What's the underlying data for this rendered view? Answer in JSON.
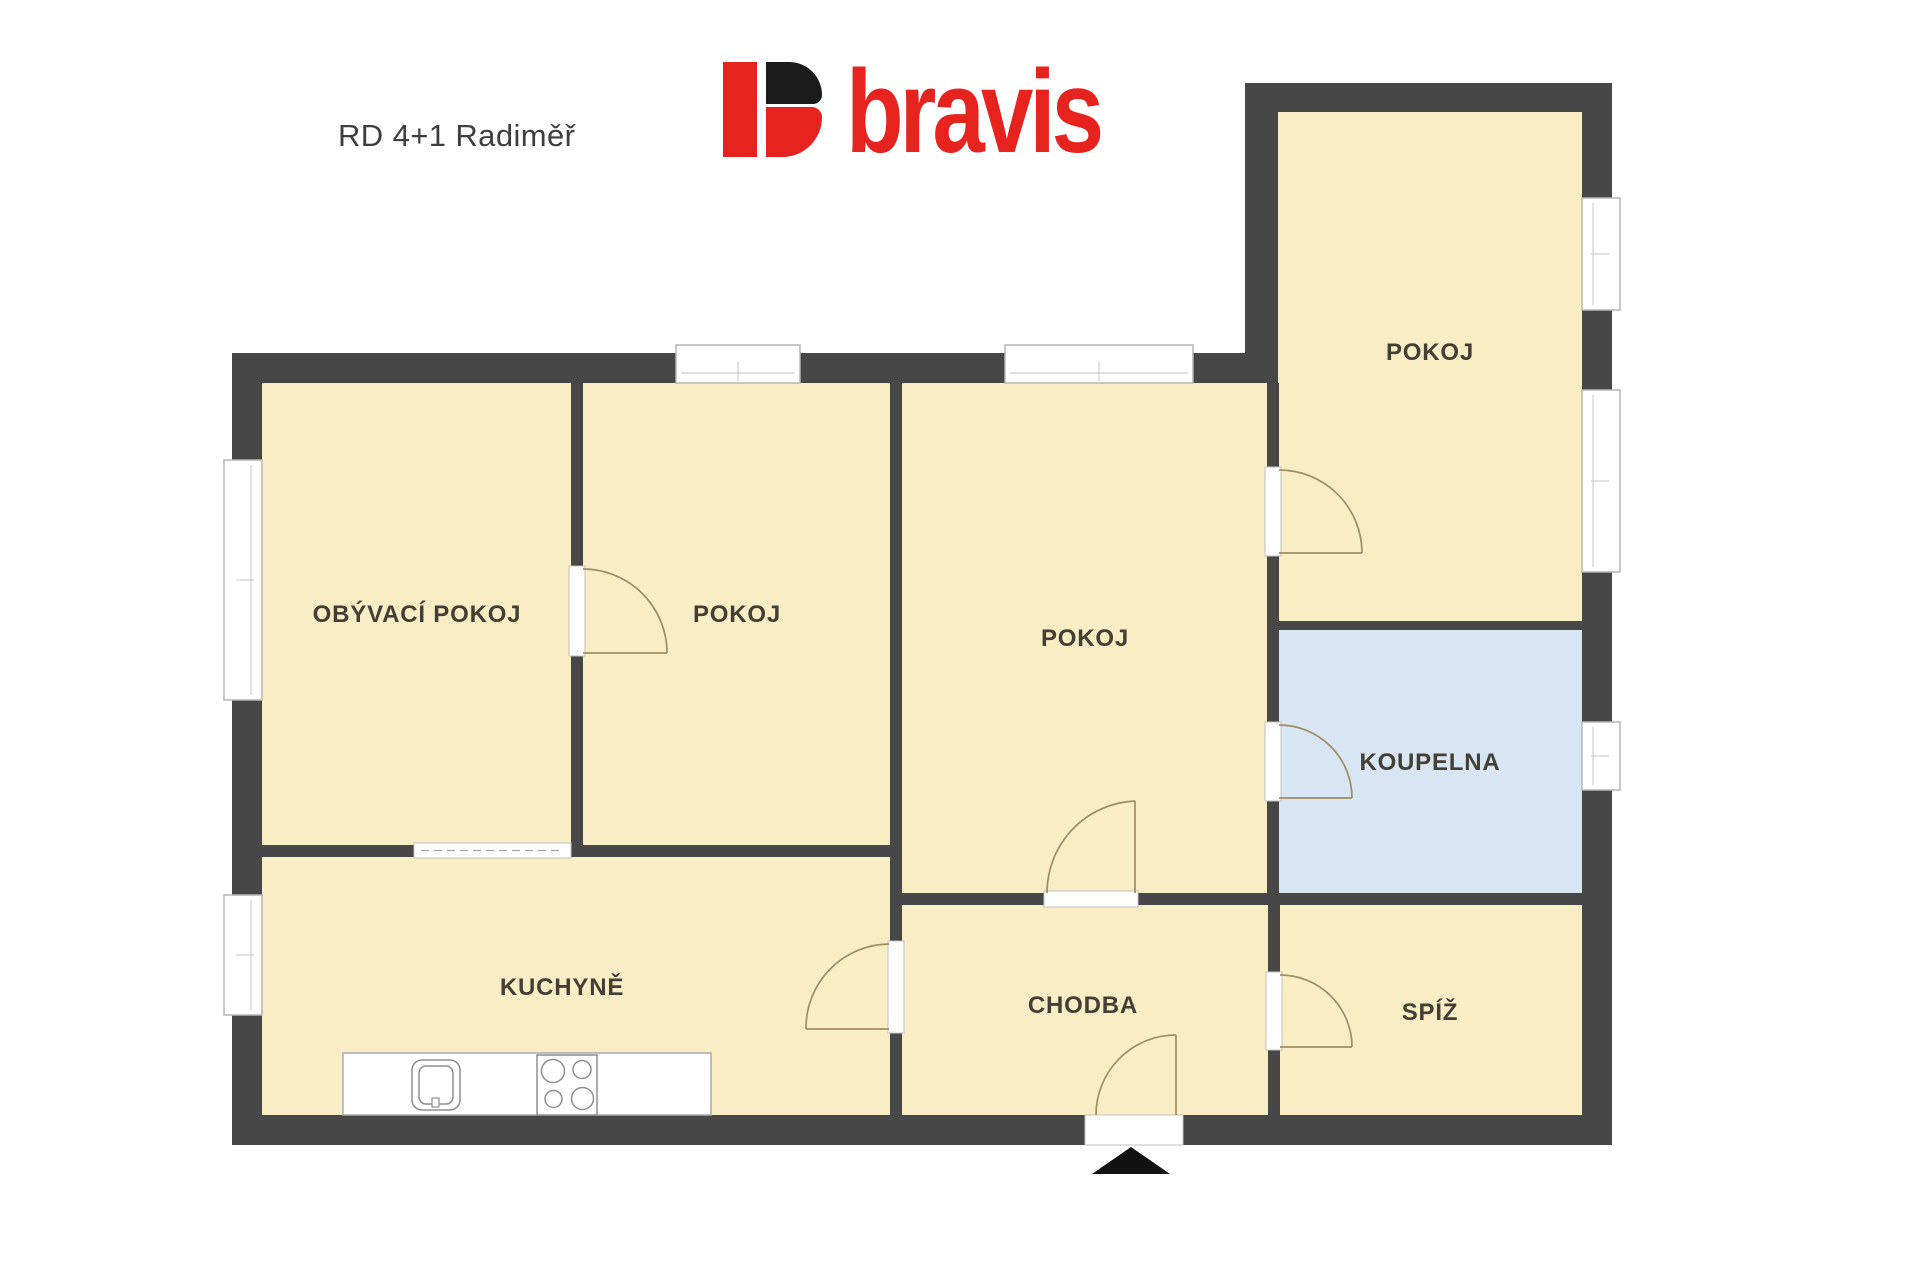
{
  "header": {
    "title": "RD 4+1 Radiměř",
    "brand": "bravis"
  },
  "floor_plan": {
    "rooms": [
      {
        "id": "obyvaci-pokoj",
        "label": "OBÝVACÍ POKOJ"
      },
      {
        "id": "pokoj-horni",
        "label": "POKOJ"
      },
      {
        "id": "pokoj-stredni",
        "label": "POKOJ"
      },
      {
        "id": "pokoj-kridlo",
        "label": "POKOJ"
      },
      {
        "id": "koupelna",
        "label": "KOUPELNA"
      },
      {
        "id": "kuchyne",
        "label": "KUCHYNĚ"
      },
      {
        "id": "chodba",
        "label": "CHODBA"
      },
      {
        "id": "spiz",
        "label": "SPÍŽ"
      }
    ],
    "colors": {
      "wall": "#474747",
      "room_fill": "#f9edc6",
      "bathroom_fill": "#d8e5f3",
      "window_frame": "#b5b5b5",
      "door_arc": "#a08d62",
      "label_text": "#433f35",
      "logo_red": "#e6231e",
      "logo_black": "#1b1b1b",
      "entrance_arrow": "#111111"
    }
  }
}
